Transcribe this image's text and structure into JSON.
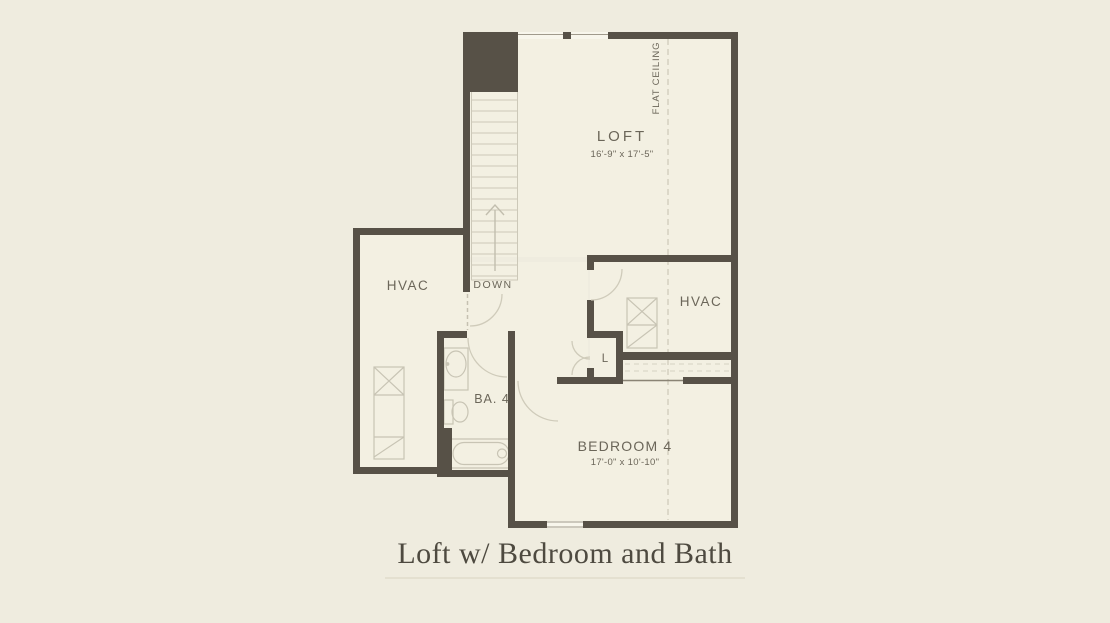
{
  "page": {
    "title": "Loft w/ Bedroom and Bath"
  },
  "colors": {
    "background": "#efecdf",
    "floor": "#f3f0e2",
    "wall": "#575147",
    "fixture_line": "#c8c4b4",
    "dashed_line": "#ccc8b8",
    "label_text": "#6b6659",
    "title_text": "#4e4a40"
  },
  "rooms": {
    "loft": {
      "name": "LOFT",
      "dims": "16'-9\" x 17'-5\""
    },
    "hvac_left": {
      "name": "HVAC"
    },
    "hvac_right": {
      "name": "HVAC"
    },
    "bath": {
      "name": "BA. 4"
    },
    "bedroom": {
      "name": "BEDROOM 4",
      "dims": "17'-0\" x 10'-10\""
    },
    "linen": {
      "name": "L"
    }
  },
  "annotations": {
    "stairs_direction": "DOWN",
    "ceiling_note": "FLAT CEILING"
  }
}
